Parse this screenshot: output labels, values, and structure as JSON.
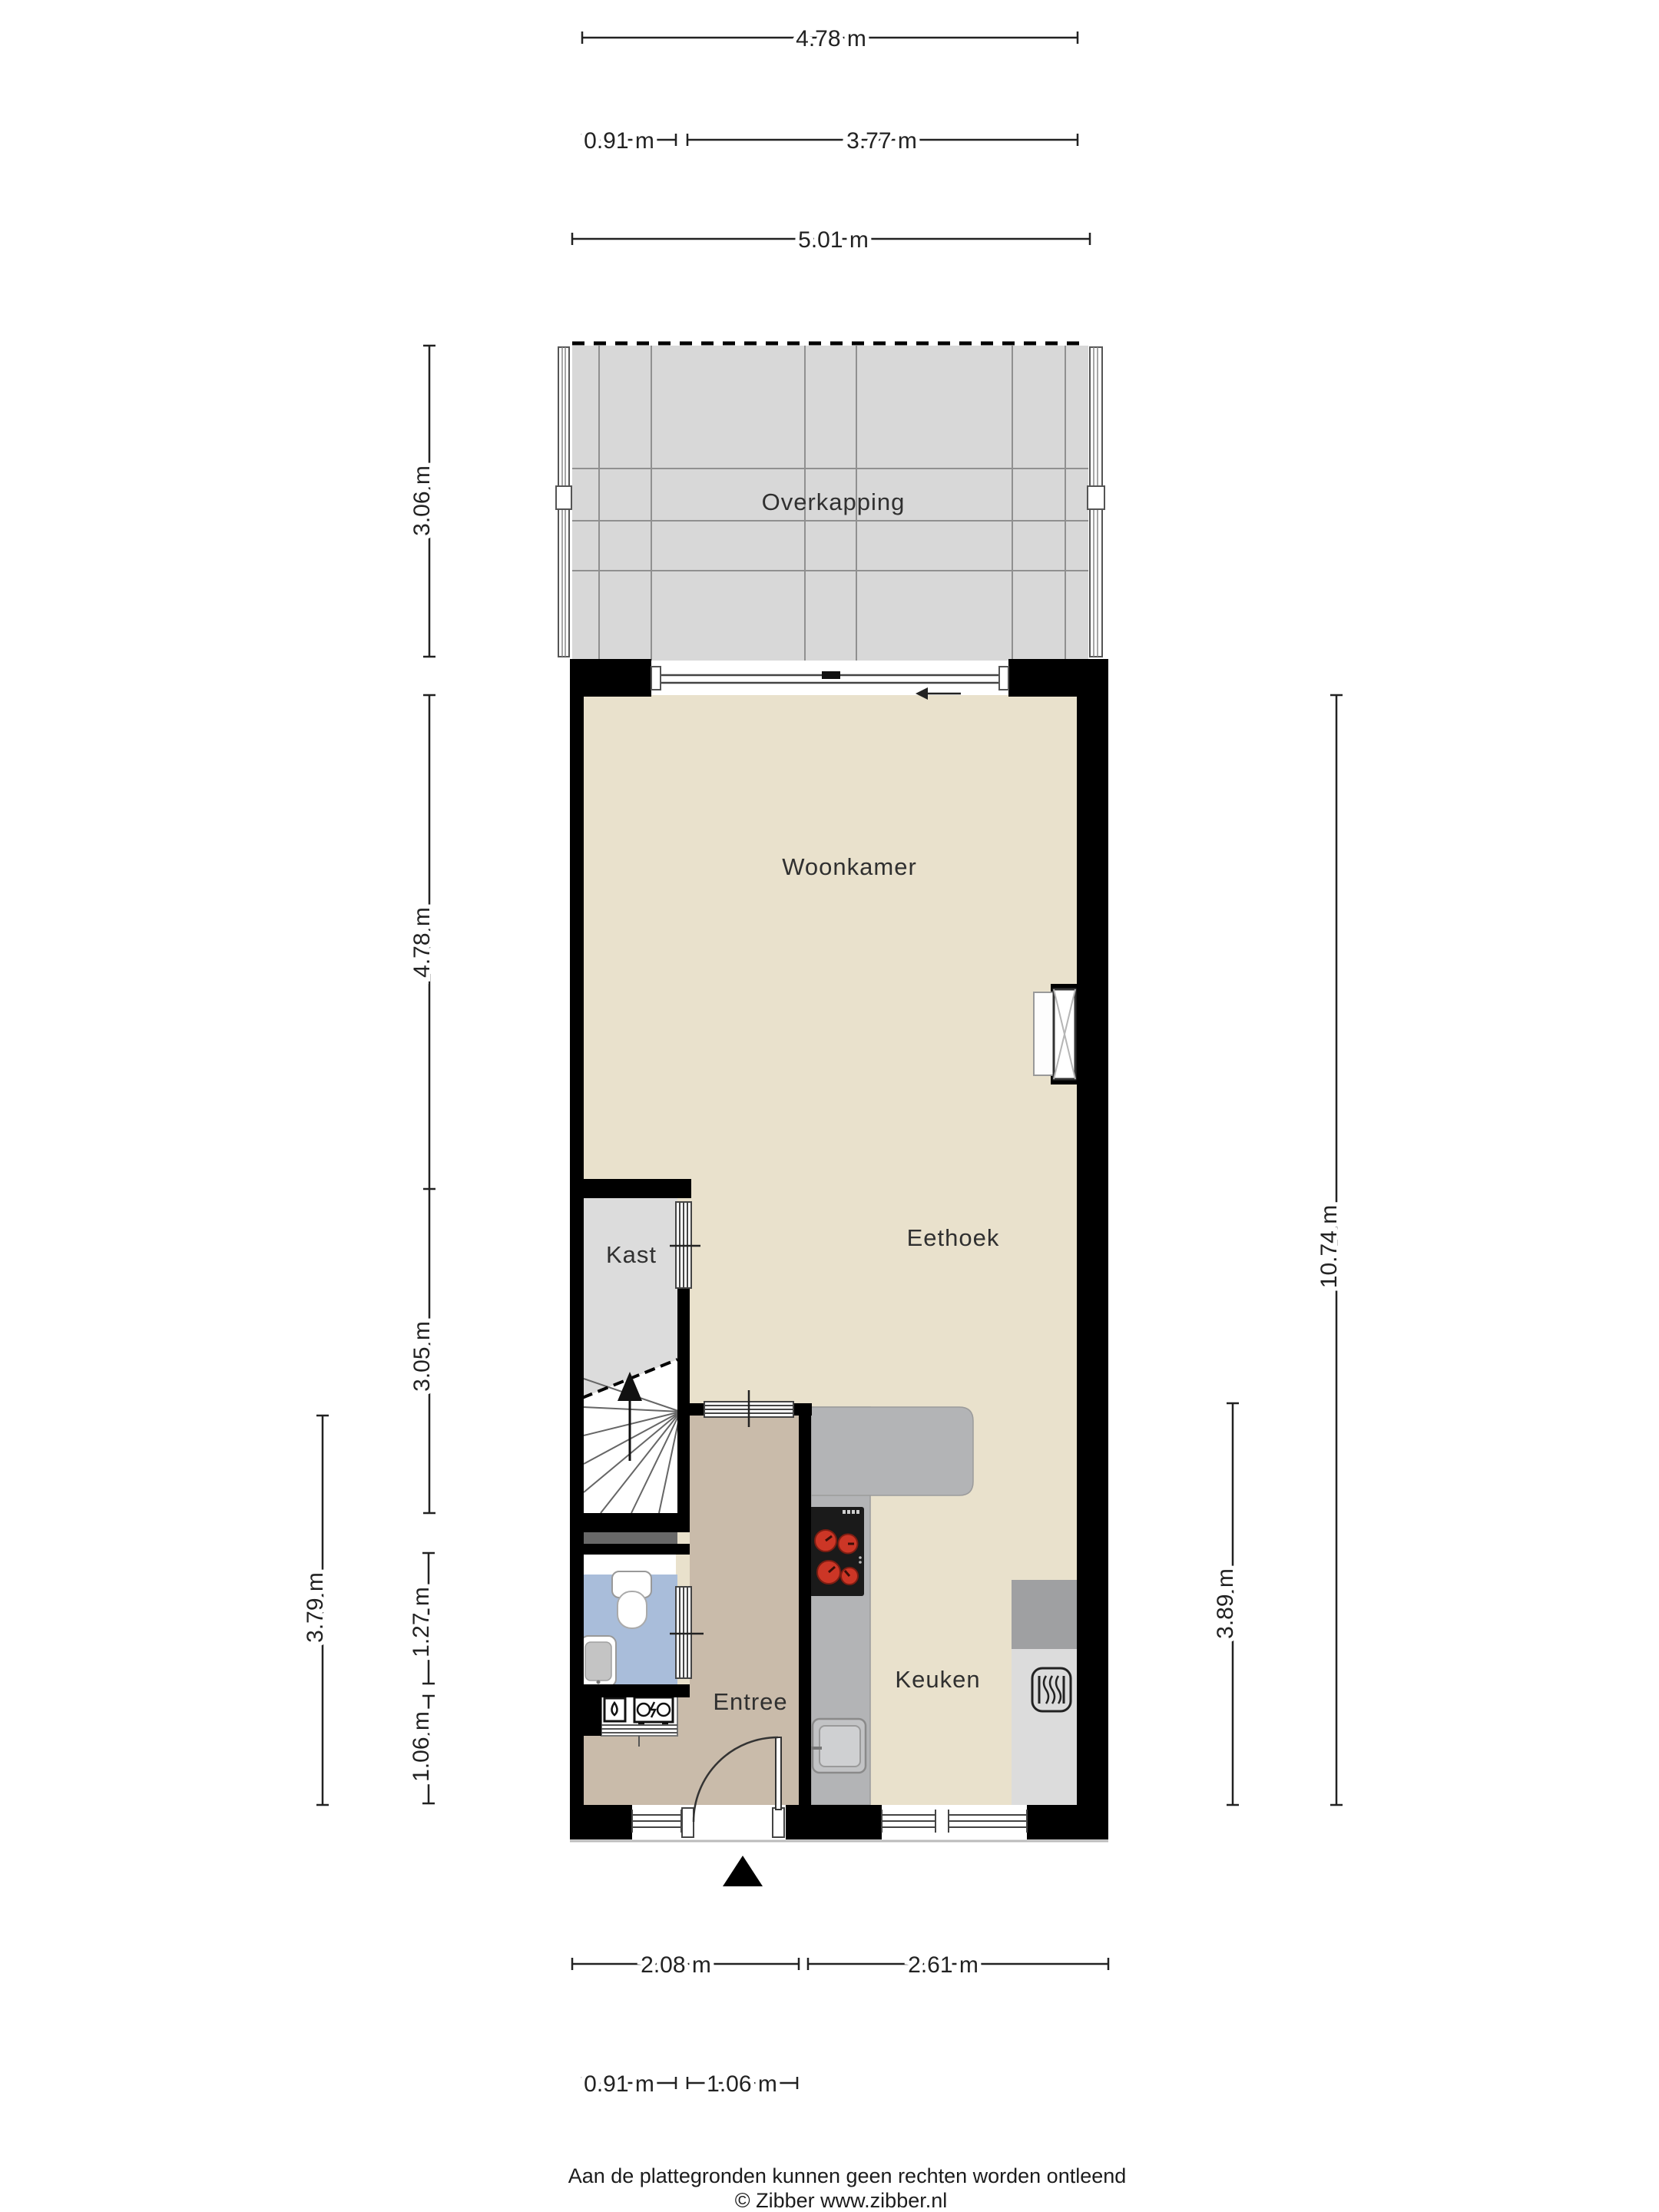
{
  "floorplan": {
    "title": "Begane grond plattegrond",
    "rooms": [
      {
        "name": "overkapping",
        "label": "Overkapping"
      },
      {
        "name": "woonkamer",
        "label": "Woonkamer"
      },
      {
        "name": "eethoek",
        "label": "Eethoek"
      },
      {
        "name": "kast",
        "label": "Kast"
      },
      {
        "name": "entree",
        "label": "Entree"
      },
      {
        "name": "keuken",
        "label": "Keuken"
      }
    ],
    "dimensions": {
      "top": [
        {
          "label": "4.78 m"
        },
        {
          "label": "0.91 m"
        },
        {
          "label": "3.77 m"
        },
        {
          "label": "5.01 m"
        }
      ],
      "left": [
        {
          "label": "3.06 m"
        },
        {
          "label": "4.78 m"
        },
        {
          "label": "3.05 m"
        },
        {
          "label": "1.27 m"
        },
        {
          "label": "1.06 m"
        },
        {
          "label": "3.79 m"
        }
      ],
      "right": [
        {
          "label": "10.74 m"
        },
        {
          "label": "3.89 m"
        }
      ],
      "bottom": [
        {
          "label": "2.08 m"
        },
        {
          "label": "2.61 m"
        },
        {
          "label": "0.91 m"
        },
        {
          "label": "1.06 m"
        }
      ]
    },
    "icons": [
      "north-arrow-icon",
      "stove-icon",
      "sink-icon",
      "heater-icon",
      "radiator-icon",
      "toilet-icon",
      "washbasin-icon",
      "water-meter-icon",
      "electricity-meter-icon",
      "sliding-door-arrow-icon",
      "stairs-up-arrow-icon"
    ],
    "colors": {
      "wall": "#000000",
      "floor_main": "#e9e1cc",
      "floor_entree": "#c9bbaa",
      "floor_kast": "#dcdcdc",
      "floor_toilet": "#a9bdda",
      "floor_overkapping": "#d8d8d8",
      "counter": "#b3b4b6",
      "appliance_dark": "#9fa0a2",
      "appliance_light": "#dcdcdc",
      "stove": "#1a1a1a",
      "burner": "#cc3626",
      "dimension_text": "#222222"
    }
  },
  "footer": {
    "disclaimer": "Aan de plattegronden kunnen geen rechten worden ontleend",
    "copyright": "© Zibber www.zibber.nl"
  }
}
